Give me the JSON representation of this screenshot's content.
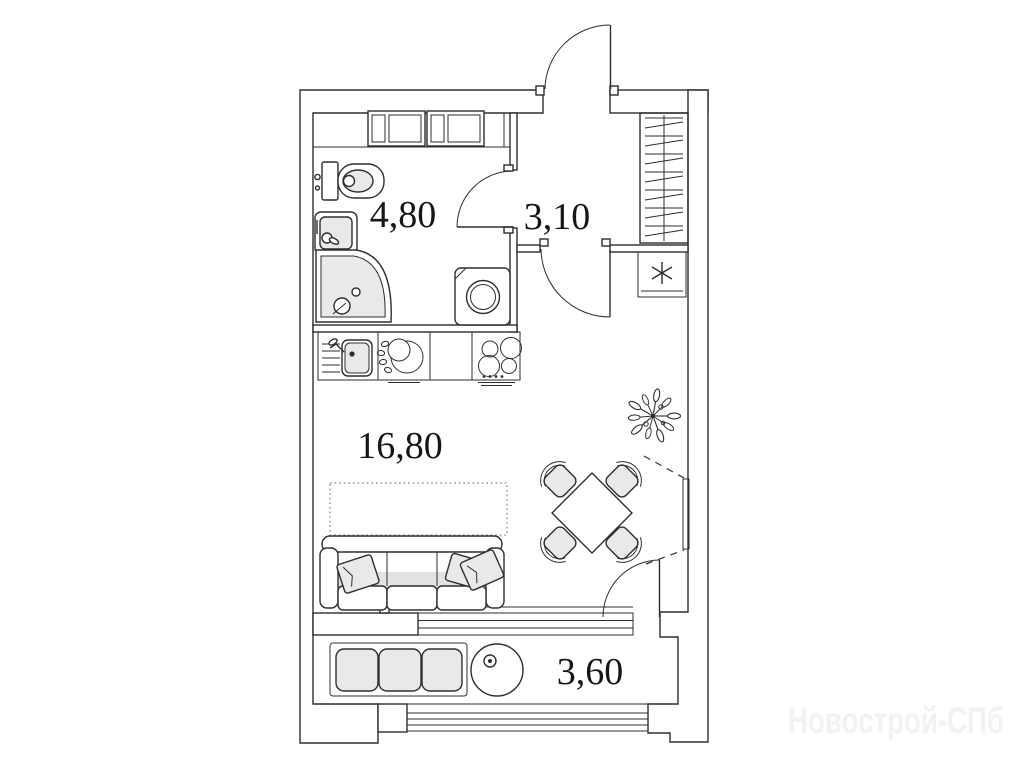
{
  "plan": {
    "colors": {
      "background": "#ffffff",
      "line": "#2e2e2e",
      "fill_light": "#e9e9e9",
      "fill_mid": "#e2e2e2",
      "label": "#161616",
      "watermark": "#f2f2f2"
    },
    "rooms": [
      {
        "name": "bathroom",
        "area_label": "4,80"
      },
      {
        "name": "hallway",
        "area_label": "3,10"
      },
      {
        "name": "living-room",
        "area_label": "16,80"
      },
      {
        "name": "balcony",
        "area_label": "3,60"
      }
    ],
    "watermark": "Новострой-СПб",
    "fixtures": [
      "storage-shelves",
      "toilet",
      "wash-basin",
      "corner-shower",
      "washing-machine",
      "wardrobe-with-hangers",
      "appliance-unit-asterisk",
      "kitchen-sink",
      "dish-rack",
      "cooktop",
      "bed-zone-dashed",
      "sofa",
      "dining-table",
      "chairs",
      "plant",
      "balcony-bench",
      "balcony-round-table",
      "entrance-door",
      "bathroom-door",
      "hall-door",
      "balcony-door",
      "window-right-dashed"
    ]
  }
}
